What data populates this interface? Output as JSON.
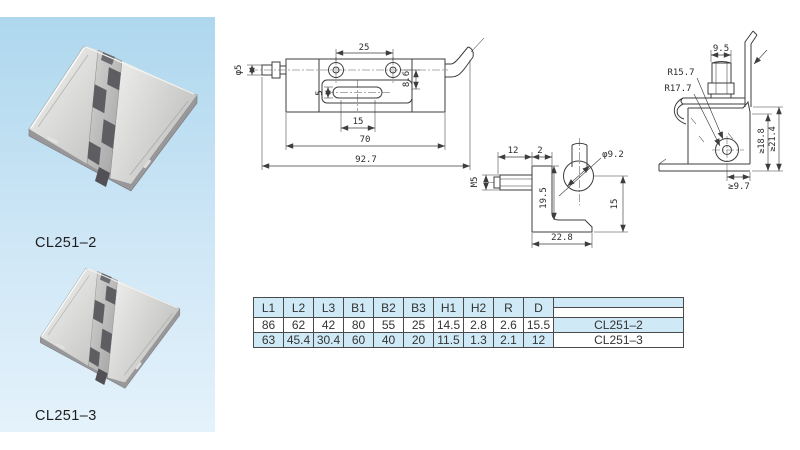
{
  "panel": {
    "products": [
      {
        "label": "CL251–2"
      },
      {
        "label": "CL251–3"
      }
    ]
  },
  "drawings": {
    "latch": {
      "dims": {
        "hole_spacing": "25",
        "pin_dia": "φ5",
        "slot_height": "5",
        "offset": "8.6",
        "slot_length": "15",
        "body_length": "70",
        "overall_length": "92.7"
      }
    },
    "bracket": {
      "dims": {
        "pin_length": "12",
        "plate_thickness": "2",
        "thread": "M5",
        "hole_dia": "φ9.2",
        "height": "19.5",
        "pivot_height": "15",
        "base_width": "22.8"
      }
    },
    "profile": {
      "dims": {
        "tab_width": "9.5",
        "radius_inner": "R15.7",
        "radius_outer": "R17.7",
        "depth_a": "≥18.8",
        "depth_b": "≥21.4",
        "clearance": "≥9.7"
      }
    }
  },
  "table": {
    "headers": [
      "L1",
      "L2",
      "L3",
      "B1",
      "B2",
      "B3",
      "H1",
      "H2",
      "R",
      "D"
    ],
    "rows": [
      {
        "values": [
          "86",
          "62",
          "42",
          "80",
          "55",
          "25",
          "14.5",
          "2.8",
          "2.6",
          "15.5"
        ],
        "model": "CL251–2"
      },
      {
        "values": [
          "63",
          "45.4",
          "30.4",
          "60",
          "40",
          "20",
          "11.5",
          "1.3",
          "2.1",
          "12"
        ],
        "model": "CL251–3"
      }
    ]
  },
  "colors": {
    "table_blue": "#cfe9f7",
    "panel_top": "#aed7ee",
    "panel_mid": "#cfe7f6",
    "panel_bottom": "#e4f2fb",
    "line": "#3d3d3d"
  }
}
